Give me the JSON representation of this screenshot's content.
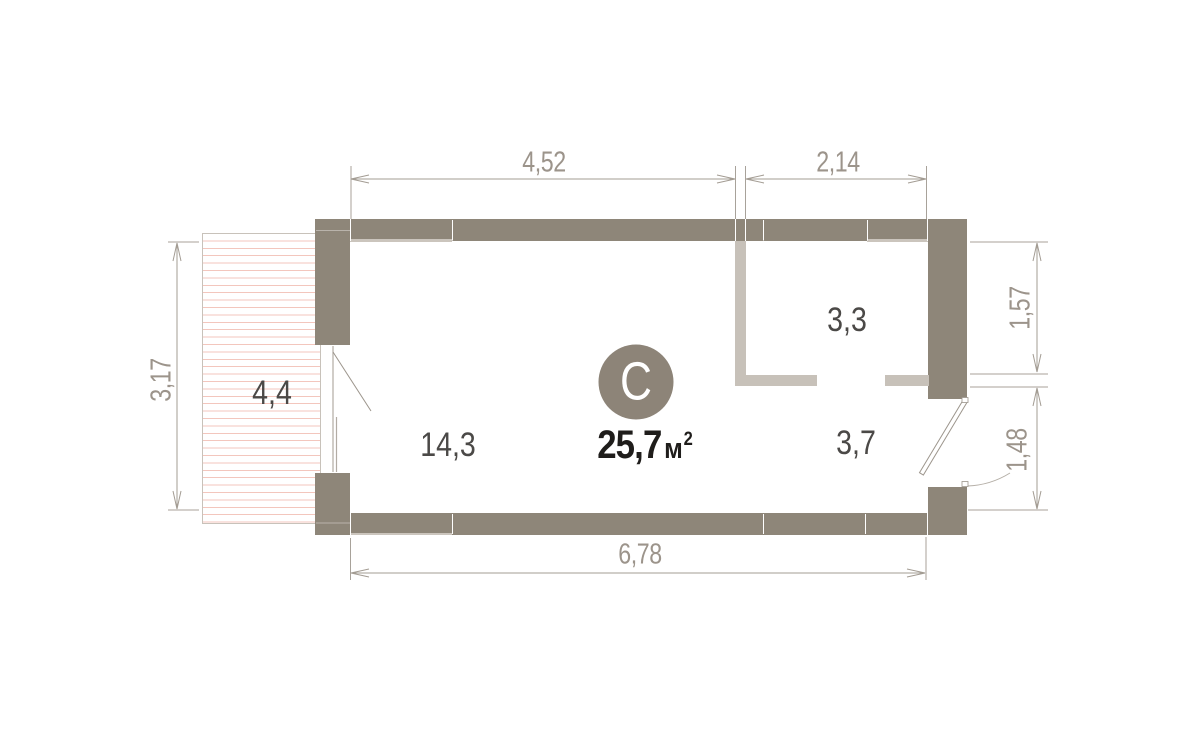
{
  "plan": {
    "badge": {
      "letter": "С"
    },
    "total_area": {
      "value": "25,7",
      "unit": "м",
      "sup": "2"
    },
    "rooms": {
      "balcony": "4,4",
      "living": "14,3",
      "wet": "3,3",
      "hall": "3,7"
    },
    "dimensions": {
      "top_left": "4,52",
      "top_right": "2,14",
      "left": "3,17",
      "right_top": "1,57",
      "right_bottom": "1,48",
      "bottom": "6,78"
    },
    "colors": {
      "wall": "#8e8679",
      "partition": "#c7c1b9",
      "hatch_line": "#f3c6bd",
      "dimension": "#9c948b",
      "room_label": "#4b4947",
      "badge": "#8d8478",
      "area_text": "#1f1d1b"
    }
  }
}
